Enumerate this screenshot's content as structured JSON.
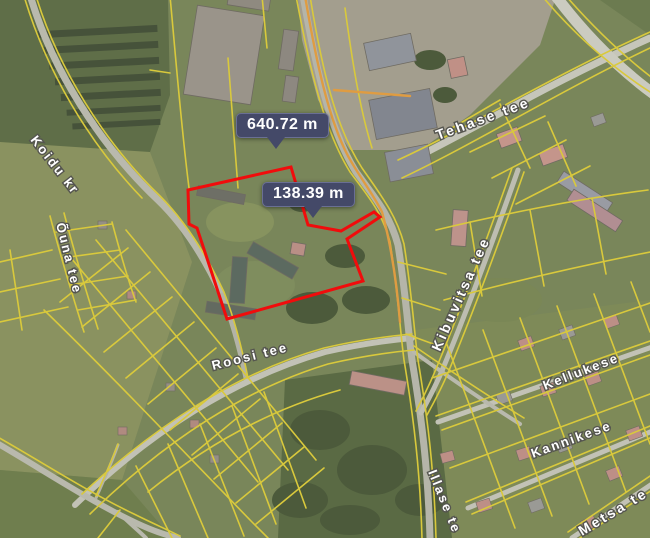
{
  "map": {
    "measurements": [
      {
        "value": "640.72 m"
      },
      {
        "value": "138.39 m"
      }
    ],
    "streets": {
      "koidu": "Koidu kr",
      "ouna": "Õuna tee",
      "tehase": "Tehase tee",
      "roosi": "Roosi tee",
      "kibuvitsa": "Kibuvitsa tee",
      "kellukese": "Kellukese",
      "kannikese": "Kannikese",
      "illase": "Illase te",
      "metsa": "Metsa te"
    },
    "colors": {
      "cadastral_line": "#d9c93c",
      "road_boundary_line": "#df9c42",
      "selected_parcel": "#f10c0c",
      "measurement_bg": "#444968",
      "measurement_text": "#ffffff"
    }
  }
}
